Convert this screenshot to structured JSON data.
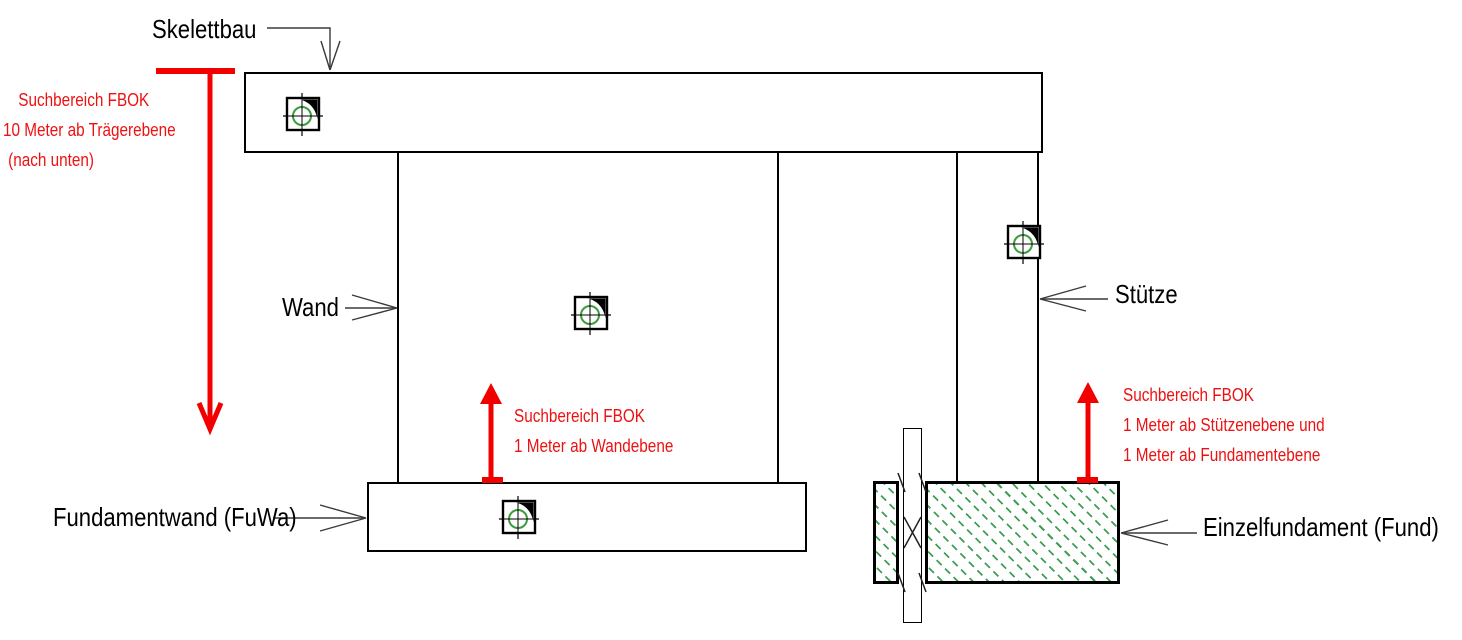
{
  "title": "Suchbereich FBOK Schema",
  "colors": {
    "annotation_red": "#ee1111",
    "hatch_green": "#3da053",
    "line_black": "#000000"
  },
  "labels": {
    "skelettbau": "Skelettbau",
    "wand": "Wand",
    "fundamentwand": "Fundamentwand (FuWa)",
    "stuetze": "Stütze",
    "einzelfundament": "Einzelfundament (Fund)"
  },
  "annotations": {
    "traeger": {
      "lines": [
        "Suchbereich FBOK",
        "10 Meter ab Trägerebene",
        "(nach unten)"
      ]
    },
    "wandebene": {
      "lines": [
        "Suchbereich FBOK",
        "1 Meter ab Wandebene"
      ]
    },
    "stuetze_fundament": {
      "lines": [
        "Suchbereich FBOK",
        "1 Meter ab Stützenebene und",
        "1 Meter ab Fundamentebene"
      ]
    }
  },
  "icons": {
    "insertion_marker": "crosshair-circle-in-square"
  }
}
